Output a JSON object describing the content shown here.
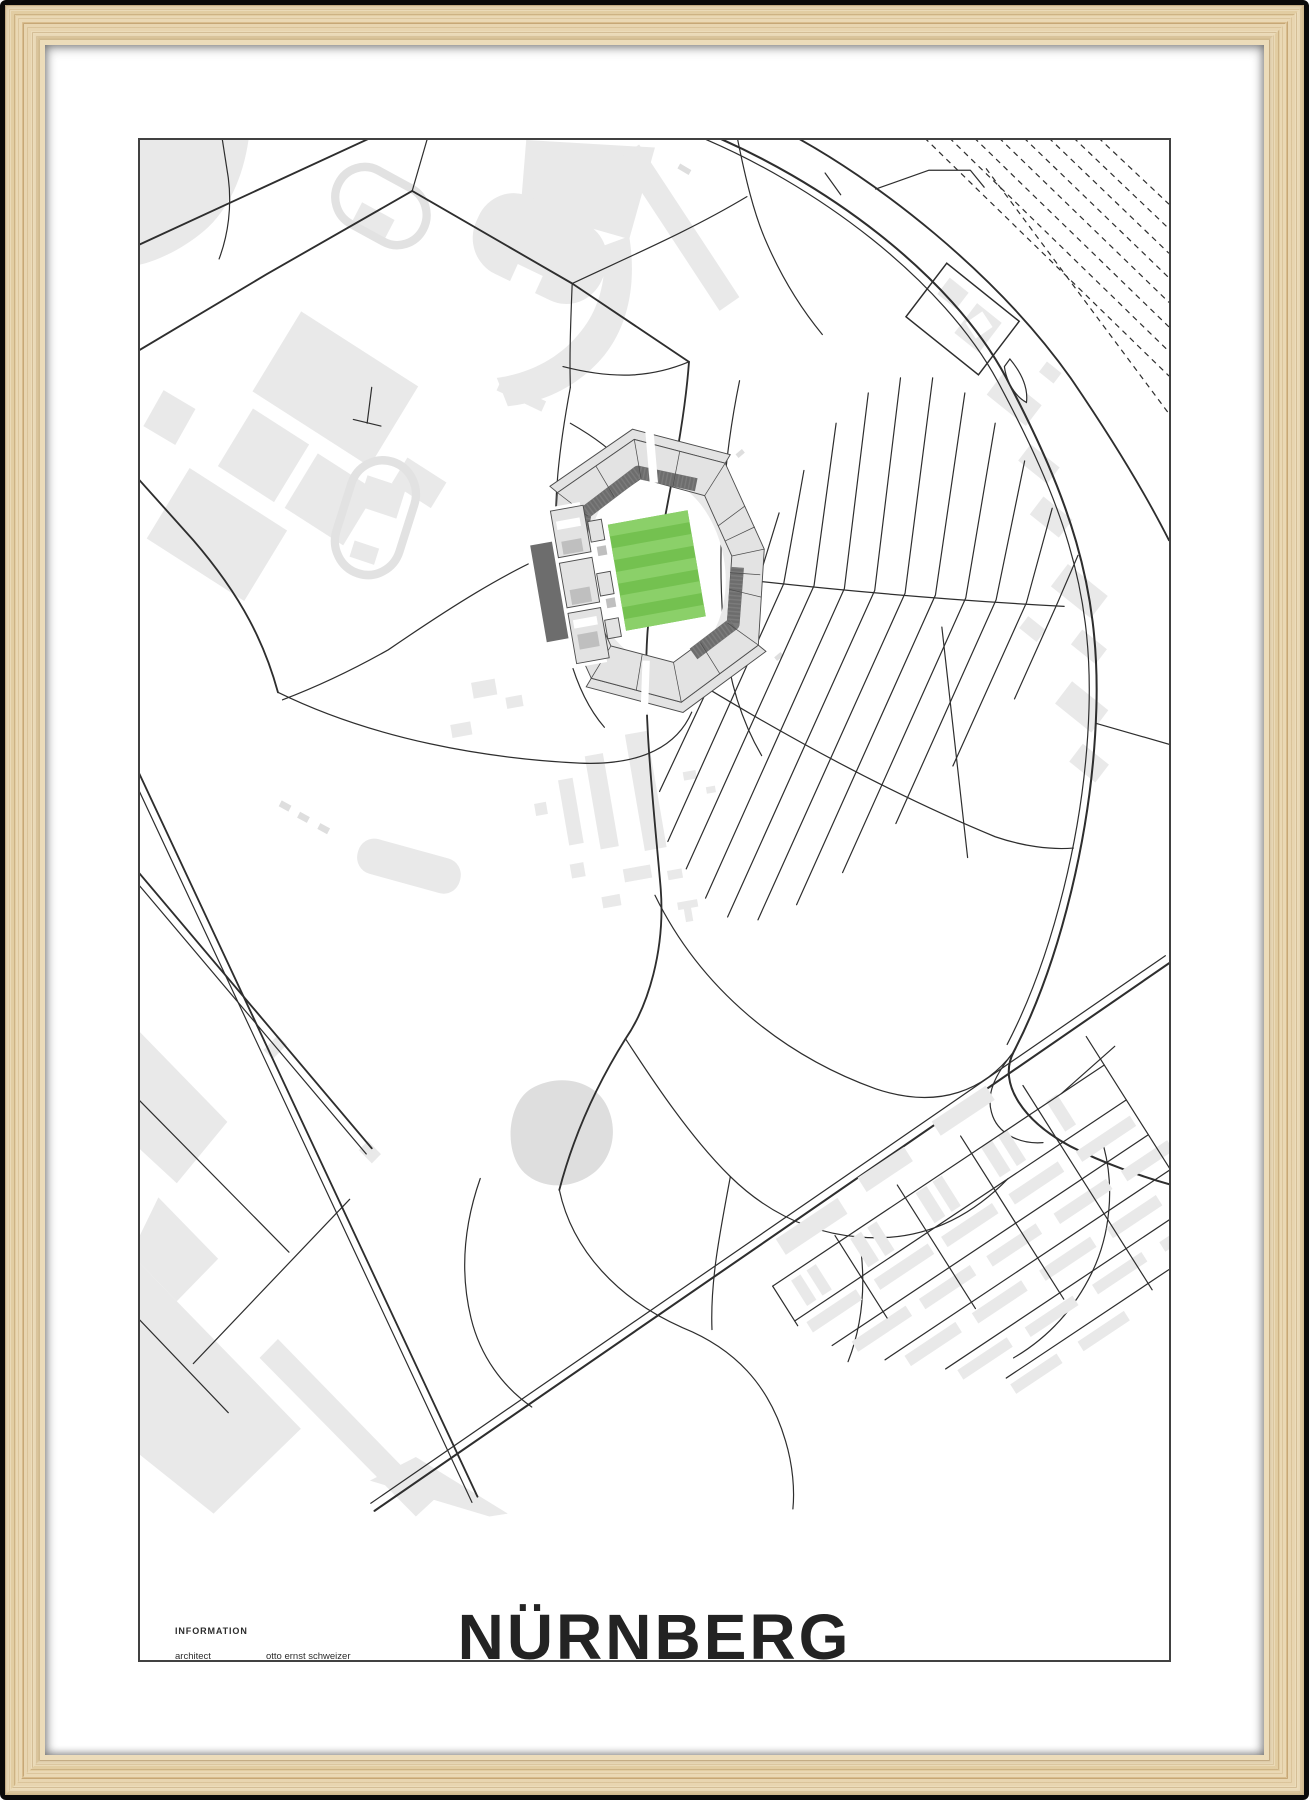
{
  "poster": {
    "title": "NÜRNBERG",
    "coordinates": "49° 25' 34.5'' N  11° 7' 32.5'' E",
    "brand": {
      "name": "playgroundplan",
      "mark": "®"
    },
    "info": {
      "heading": "INFORMATION",
      "rows": [
        {
          "label": "architect",
          "value": "otto ernst schweizer"
        },
        {
          "label": "year",
          "value": "1928"
        },
        {
          "label": "location",
          "value": "max-morlock-platz 1"
        },
        {
          "label": "capacity",
          "value": "50 000 (44 308)"
        },
        {
          "label": "surface",
          "value": "natural turf"
        },
        {
          "label": "field size",
          "value": "105 m × 68 m"
        }
      ]
    }
  },
  "colors": {
    "pitch_green": "#74c150",
    "pitch_green_light": "#8bd069",
    "building_gray": "#e9e9e9",
    "stand_dark": "#6d6d6d",
    "stand_light": "#e3e3e3",
    "road": "#2e2e2e",
    "wood_light": "#ecdcba",
    "wood_dark": "#d9bd8e",
    "matte": "#ffffff",
    "text_dark": "#2c2c2c",
    "text_gray": "#4b4b4b"
  }
}
